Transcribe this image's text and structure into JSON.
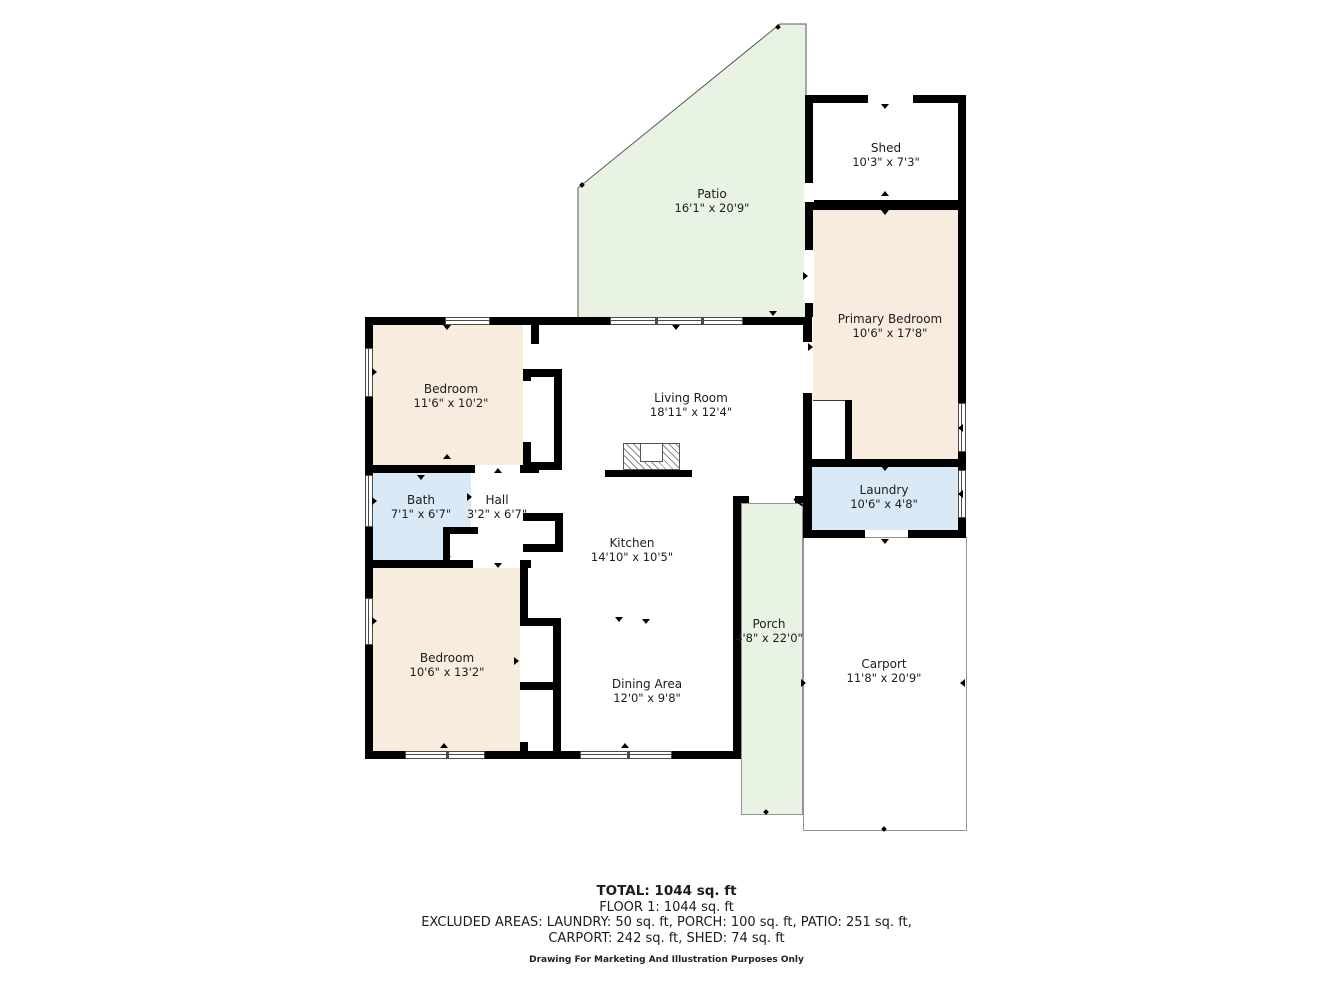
{
  "plan": {
    "rooms": [
      {
        "id": "patio",
        "name": "Patio",
        "dims": "16'1\" x 20'9\""
      },
      {
        "id": "shed",
        "name": "Shed",
        "dims": "10'3\" x 7'3\""
      },
      {
        "id": "primary-bedroom",
        "name": "Primary Bedroom",
        "dims": "10'6\" x 17'8\""
      },
      {
        "id": "bedroom-top",
        "name": "Bedroom",
        "dims": "11'6\" x 10'2\""
      },
      {
        "id": "living-room",
        "name": "Living Room",
        "dims": "18'11\" x 12'4\""
      },
      {
        "id": "bath",
        "name": "Bath",
        "dims": "7'1\" x 6'7\""
      },
      {
        "id": "hall",
        "name": "Hall",
        "dims": "3'2\" x 6'7\""
      },
      {
        "id": "laundry",
        "name": "Laundry",
        "dims": "10'6\" x 4'8\""
      },
      {
        "id": "kitchen",
        "name": "Kitchen",
        "dims": "14'10\" x 10'5\""
      },
      {
        "id": "bedroom-bottom",
        "name": "Bedroom",
        "dims": "10'6\" x 13'2\""
      },
      {
        "id": "porch",
        "name": "Porch",
        "dims": "4'8\" x 22'0\""
      },
      {
        "id": "carport",
        "name": "Carport",
        "dims": "11'8\" x 20'9\""
      },
      {
        "id": "dining-area",
        "name": "Dining Area",
        "dims": "12'0\" x 9'8\""
      }
    ],
    "footer": {
      "total": "TOTAL: 1044 sq. ft",
      "floor": "FLOOR 1: 1044 sq. ft",
      "excluded_line1": "EXCLUDED AREAS: LAUNDRY: 50 sq. ft, PORCH: 100 sq. ft, PATIO: 251 sq. ft,",
      "excluded_line2": "CARPORT: 242 sq. ft, SHED: 74 sq. ft",
      "disclaimer": "Drawing For Marketing And Illustration Purposes Only"
    },
    "colors": {
      "wall": "#000000",
      "room_fill": "#f8ecdf",
      "wet_room_fill": "#d9e9f6",
      "outdoor_fill": "#e9f3e3",
      "carport_fill": "#ffffff",
      "outline": "#949494"
    }
  }
}
